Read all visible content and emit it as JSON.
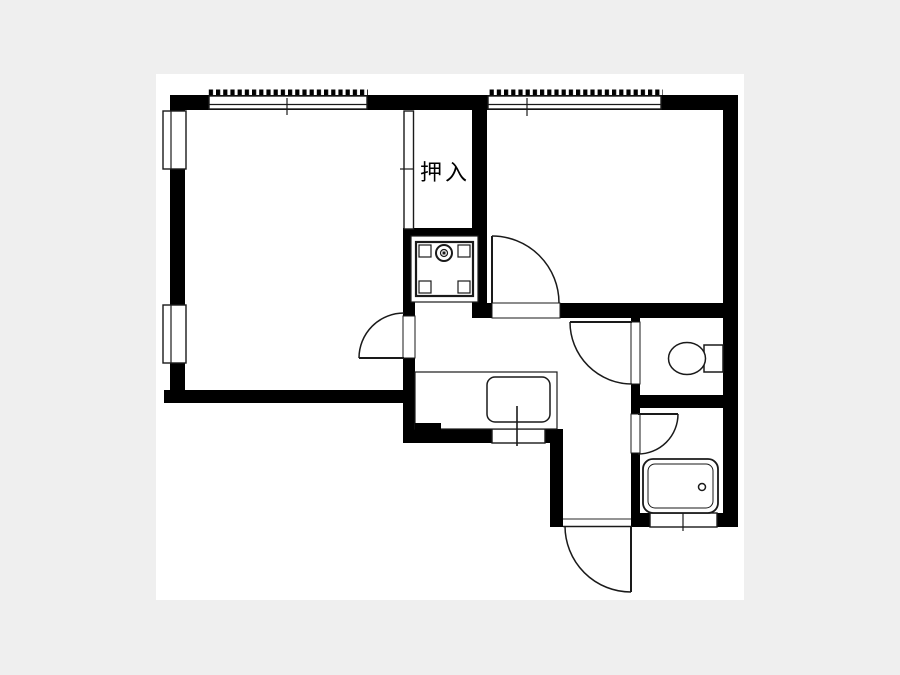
{
  "page": {
    "bg": "#efefef"
  },
  "paper": {
    "x": 156,
    "y": 74,
    "w": 588,
    "h": 526,
    "fill": "#ffffff"
  },
  "colors": {
    "wall": "#000000",
    "line": "#1a1a1a"
  },
  "labels": {
    "closet": "押入"
  },
  "walls": [
    {
      "name": "wall-top",
      "x": 170,
      "y": 95,
      "w": 568,
      "h": 15
    },
    {
      "name": "wall-left",
      "x": 170,
      "y": 110,
      "w": 15,
      "h": 293
    },
    {
      "name": "wall-leftroom-bottom",
      "x": 164,
      "y": 390,
      "w": 251,
      "h": 13
    },
    {
      "name": "wall-closet-bottom",
      "x": 403,
      "y": 228,
      "w": 84,
      "h": 12
    },
    {
      "name": "wall-center-upper",
      "x": 403,
      "y": 240,
      "w": 12,
      "h": 78
    },
    {
      "name": "wall-center-lower",
      "x": 403,
      "y": 358,
      "w": 12,
      "h": 85
    },
    {
      "name": "wall-closet-right",
      "x": 472,
      "y": 95,
      "w": 15,
      "h": 223
    },
    {
      "name": "wall-door-post",
      "x": 477,
      "y": 303,
      "w": 15,
      "h": 15
    },
    {
      "name": "wall-hall-top",
      "x": 560,
      "y": 303,
      "w": 178,
      "h": 15
    },
    {
      "name": "wall-right",
      "x": 723,
      "y": 95,
      "w": 15,
      "h": 432
    },
    {
      "name": "wall-toilet-left-top",
      "x": 631,
      "y": 318,
      "w": 9,
      "h": 5
    },
    {
      "name": "wall-toilet-left-mid",
      "x": 631,
      "y": 384,
      "w": 9,
      "h": 31
    },
    {
      "name": "wall-toilet-bottom",
      "x": 631,
      "y": 395,
      "w": 107,
      "h": 13
    },
    {
      "name": "wall-bath-left",
      "x": 631,
      "y": 453,
      "w": 9,
      "h": 67
    },
    {
      "name": "wall-bath-bottom-left",
      "x": 633,
      "y": 513,
      "w": 18,
      "h": 14
    },
    {
      "name": "wall-bath-bottom-right",
      "x": 716,
      "y": 513,
      "w": 22,
      "h": 14
    },
    {
      "name": "wall-kitchen-bottom",
      "x": 405,
      "y": 429,
      "w": 88,
      "h": 14
    },
    {
      "name": "wall-kitchen-bottom-right",
      "x": 544,
      "y": 429,
      "w": 19,
      "h": 14
    },
    {
      "name": "wall-entry-left",
      "x": 550,
      "y": 433,
      "w": 13,
      "h": 94
    },
    {
      "name": "wall-entry-right-post",
      "x": 631,
      "y": 518,
      "w": 20,
      "h": 9
    }
  ],
  "openings": [
    {
      "name": "opening-leftroom-door",
      "x": 403,
      "y": 316,
      "w": 12,
      "h": 42
    },
    {
      "name": "opening-rightroom-door",
      "x": 492,
      "y": 303,
      "w": 68,
      "h": 15
    },
    {
      "name": "opening-toilet-door",
      "x": 631,
      "y": 322,
      "w": 9,
      "h": 62
    },
    {
      "name": "opening-bath-door",
      "x": 631,
      "y": 414,
      "w": 9,
      "h": 39
    }
  ],
  "windows": [
    {
      "name": "window-top-left",
      "base": {
        "x": 209,
        "y": 96,
        "w": 158,
        "h": 13
      },
      "ticks": {
        "x": 208,
        "y": 89.5,
        "w": 160,
        "h": 6
      },
      "lines": [
        [
          209,
          104.5,
          367,
          104.5
        ],
        [
          287,
          98,
          287,
          115
        ]
      ]
    },
    {
      "name": "window-top-right",
      "base": {
        "x": 488,
        "y": 96,
        "w": 173,
        "h": 13
      },
      "ticks": {
        "x": 487,
        "y": 89.5,
        "w": 176,
        "h": 6
      },
      "lines": [
        [
          488,
          104.5,
          661,
          104.5
        ],
        [
          527,
          98,
          527,
          116
        ]
      ]
    },
    {
      "name": "window-left-upper",
      "base": {
        "x": 163,
        "y": 111,
        "w": 23,
        "h": 58
      },
      "lines": [
        [
          171,
          111,
          171,
          169
        ]
      ]
    },
    {
      "name": "window-left-lower",
      "base": {
        "x": 163,
        "y": 305,
        "w": 23,
        "h": 58
      },
      "lines": [
        [
          171,
          305,
          171,
          363
        ]
      ]
    },
    {
      "name": "window-kitchen",
      "base": {
        "x": 492,
        "y": 429,
        "w": 53,
        "h": 14
      },
      "lines": []
    },
    {
      "name": "window-bath",
      "base": {
        "x": 650,
        "y": 513,
        "w": 67,
        "h": 14
      },
      "lines": [
        [
          683,
          509,
          683,
          531
        ]
      ]
    },
    {
      "name": "closet-sliding-door",
      "base": {
        "x": 404,
        "y": 111,
        "w": 9.5,
        "h": 118
      },
      "lines": [
        [
          400,
          169,
          413.5,
          169
        ]
      ]
    }
  ],
  "doors": [
    {
      "name": "door-left-room",
      "leaf": [
        404,
        358,
        359,
        358
      ],
      "arc": {
        "r": 45,
        "from": [
          359,
          358
        ],
        "to": [
          404,
          313
        ],
        "sweep": 1
      }
    },
    {
      "name": "door-right-room",
      "leaf": [
        492,
        303,
        492,
        236
      ],
      "arc": {
        "r": 67,
        "from": [
          492,
          236
        ],
        "to": [
          559,
          303
        ],
        "sweep": 1
      }
    },
    {
      "name": "door-toilet",
      "leaf": [
        632,
        322,
        570,
        322
      ],
      "arc": {
        "r": 62,
        "from": [
          570,
          322
        ],
        "to": [
          632,
          384
        ],
        "sweep": 0
      }
    },
    {
      "name": "door-bath",
      "leaf": [
        638,
        414,
        678,
        414
      ],
      "arc": {
        "r": 40,
        "from": [
          678,
          414
        ],
        "to": [
          638,
          454
        ],
        "sweep": 1
      }
    },
    {
      "name": "door-entrance",
      "leaf": [
        631,
        526,
        631,
        592
      ],
      "arc": {
        "r": 66,
        "from": [
          631,
          592
        ],
        "to": [
          565,
          526
        ],
        "sweep": 1
      }
    }
  ],
  "fixtures": [
    {
      "name": "washer-pan-outer",
      "type": "rect",
      "x": 411,
      "y": 236,
      "w": 67,
      "h": 66,
      "sw": 1.2
    },
    {
      "name": "washer-pan-inner",
      "type": "rect",
      "x": 416,
      "y": 242,
      "w": 57,
      "h": 54,
      "sw": 2.2
    },
    {
      "name": "washer-pan-corner-tl",
      "type": "rect",
      "x": 419,
      "y": 245,
      "w": 12,
      "h": 12,
      "sw": 1.2
    },
    {
      "name": "washer-pan-corner-tr",
      "type": "rect",
      "x": 458,
      "y": 245,
      "w": 12,
      "h": 12,
      "sw": 1.2
    },
    {
      "name": "washer-pan-corner-bl",
      "type": "rect",
      "x": 419,
      "y": 281,
      "w": 12,
      "h": 12,
      "sw": 1.2
    },
    {
      "name": "washer-pan-corner-br",
      "type": "rect",
      "x": 458,
      "y": 281,
      "w": 12,
      "h": 12,
      "sw": 1.2
    },
    {
      "name": "washer-faucet-outer",
      "type": "circle",
      "cx": 444,
      "cy": 253,
      "r": 8,
      "sw": 2
    },
    {
      "name": "washer-faucet-inner",
      "type": "circle",
      "cx": 444,
      "cy": 253,
      "r": 3.5,
      "sw": 1.2
    },
    {
      "name": "washer-faucet-dot",
      "type": "rect",
      "x": 442.5,
      "y": 251.5,
      "w": 3,
      "h": 3,
      "sw": 0,
      "fill": "#1a1a1a"
    },
    {
      "name": "kitchen-counter",
      "type": "rect",
      "x": 415,
      "y": 372,
      "w": 142,
      "h": 57,
      "sw": 1.2
    },
    {
      "name": "kitchen-sink",
      "type": "rrect",
      "x": 487,
      "y": 377,
      "w": 63,
      "h": 45,
      "rx": 8,
      "sw": 1.5
    },
    {
      "name": "kitchen-faucet",
      "type": "line",
      "x1": 517,
      "y1": 406,
      "x2": 517,
      "y2": 446,
      "sw": 1.6
    },
    {
      "name": "wall-kitchen-step",
      "type": "rect",
      "x": 415,
      "y": 423,
      "w": 26,
      "h": 8,
      "sw": 0,
      "fill": "#000000"
    },
    {
      "name": "toilet-tank",
      "type": "rect",
      "x": 704,
      "y": 345,
      "w": 19,
      "h": 27,
      "sw": 1.5
    },
    {
      "name": "toilet-bowl",
      "type": "ellipse",
      "cx": 687,
      "cy": 358.5,
      "rx": 18.5,
      "ry": 16,
      "sw": 1.5
    },
    {
      "name": "bathtub-outer",
      "type": "rrect",
      "x": 643,
      "y": 459,
      "w": 75,
      "h": 54,
      "rx": 10,
      "sw": 1.8
    },
    {
      "name": "bathtub-inner",
      "type": "rrect",
      "x": 648,
      "y": 464,
      "w": 65,
      "h": 44,
      "rx": 7,
      "sw": 1
    },
    {
      "name": "bathtub-drain",
      "type": "circle",
      "cx": 702,
      "cy": 487,
      "r": 3.5,
      "sw": 1.5
    },
    {
      "name": "genkan-step-upper",
      "type": "line",
      "x1": 563,
      "y1": 519,
      "x2": 631,
      "y2": 519,
      "sw": 1.2,
      "color": "#555555"
    },
    {
      "name": "genkan-step-lower",
      "type": "line",
      "x1": 563,
      "y1": 526.5,
      "x2": 631,
      "y2": 526.5,
      "sw": 1.4
    }
  ]
}
